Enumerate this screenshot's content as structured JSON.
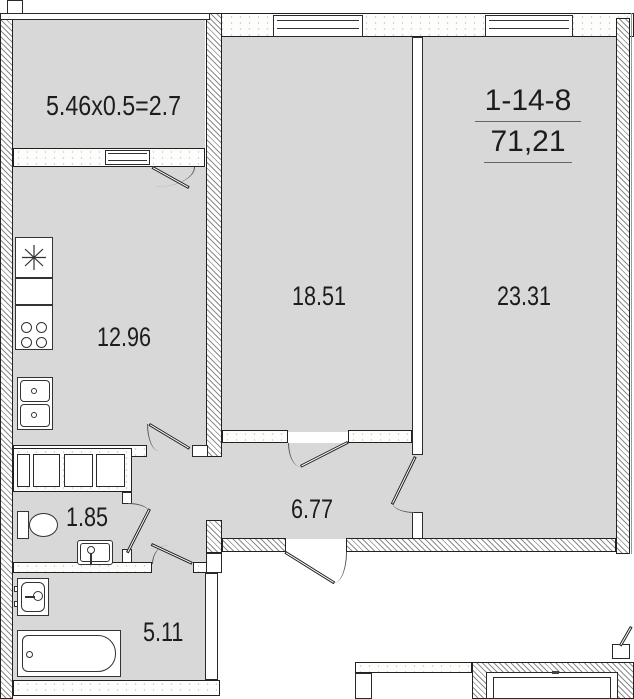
{
  "plan": {
    "unit_number": "1-14-8",
    "total_area": "71,21",
    "rooms": {
      "balcony": "5.46x0.5=2.7",
      "kitchen": "12.96",
      "living": "18.51",
      "bedroom": "23.31",
      "wc": "1.85",
      "hall": "6.77",
      "bathroom": "5.11"
    },
    "colors": {
      "floor": "#d8d8d8",
      "line": "#222222"
    }
  }
}
